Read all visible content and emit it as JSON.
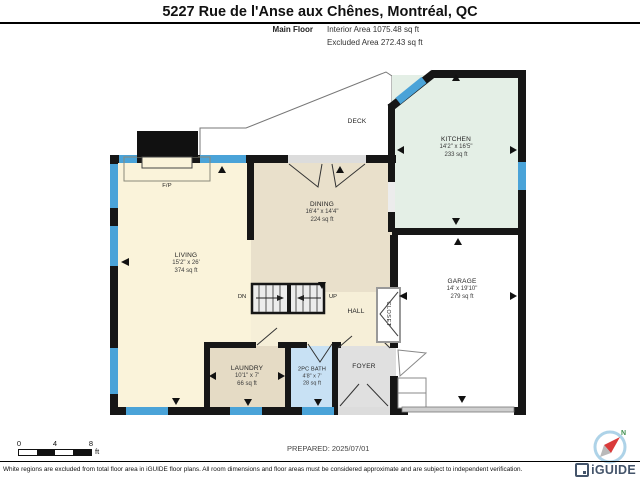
{
  "header": {
    "title": "5227 Rue de l'Anse aux Chênes, Montréal, QC",
    "floor_label": "Main Floor",
    "area_lines": [
      "Interior Area 1075.48 sq ft",
      "Excluded Area 272.43 sq ft"
    ]
  },
  "rooms": {
    "kitchen": {
      "name": "KITCHEN",
      "dims": "14'2\" x 16'5\"",
      "area": "233 sq ft"
    },
    "dining": {
      "name": "DINING",
      "dims": "16'4\" x 14'4\"",
      "area": "224 sq ft"
    },
    "living": {
      "name": "LIVING",
      "dims": "15'2\" x 26'",
      "area": "374 sq ft"
    },
    "garage": {
      "name": "GARAGE",
      "dims": "14' x 19'10\"",
      "area": "279 sq ft"
    },
    "laundry": {
      "name": "LAUNDRY",
      "dims": "10'1\" x 7'",
      "area": "66 sq ft"
    },
    "bath": {
      "name": "2PC BATH",
      "dims": "4'8\" x 7'",
      "area": "28 sq ft"
    },
    "foyer": {
      "name": "FOYER"
    },
    "hall": {
      "name": "HALL"
    },
    "closet": {
      "name": "CLOSET"
    },
    "deck": {
      "name": "DECK"
    },
    "fireplace": {
      "name": "F/P"
    },
    "stairs": {
      "down": "DN",
      "up": "UP"
    }
  },
  "scale_bar": {
    "ticks": [
      "0",
      "4",
      "8"
    ],
    "unit": "ft"
  },
  "prepared": "PREPARED: 2025/07/01",
  "compass": {
    "north_label": "N"
  },
  "footer": {
    "disclaimer": "White regions are excluded from total floor area in iGUIDE floor plans. All room dimensions and floor areas must be considered approximate and are subject to independent verification.",
    "brand": "iGUIDE"
  },
  "colors": {
    "wall": "#161616",
    "window": "#4aa3d8",
    "living_fill": "#faf3da",
    "dining_fill": "#e9e0cb",
    "kitchen_fill": "#e4efe6",
    "bath_fill": "#c8e1f4",
    "foyer_fill": "#e0e0e0",
    "brand_navy": "#44546a",
    "compass_red": "#d93a3a"
  }
}
